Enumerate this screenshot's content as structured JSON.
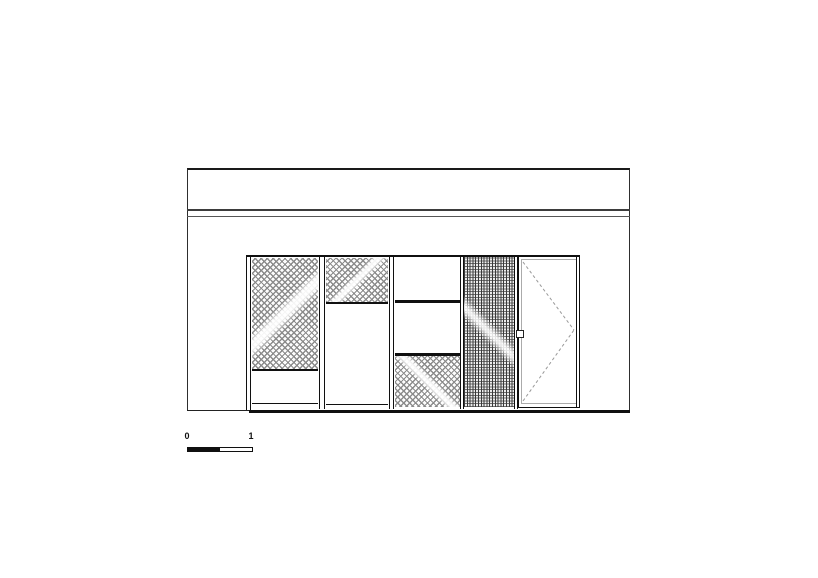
{
  "drawing": {
    "type": "architectural-front-elevation",
    "scale_bar": {
      "start_label": "0",
      "end_label": "1"
    },
    "facade": {
      "parapet_lines": 2,
      "panels": [
        {
          "id": "panel-1",
          "pattern": "mesh",
          "layout": "mesh-top-solid-bottom"
        },
        {
          "id": "panel-2",
          "pattern": "mesh",
          "layout": "mesh-top-tall-solid-bottom"
        },
        {
          "id": "panel-3",
          "pattern": "mesh",
          "layout": "solid-solid-mesh-bottom"
        },
        {
          "id": "panel-4",
          "pattern": "dense-mesh",
          "layout": "full-height-mesh"
        },
        {
          "id": "door",
          "pattern": "plain",
          "swing_indicator": "dashed-diagonals-to-right-jamb",
          "handle_side": "left"
        }
      ]
    },
    "colors": {
      "line": "#1a1a1a",
      "mesh_hatch": "#8b8b8b",
      "dense_hatch": "#3a3a3a",
      "swing_dash": "#999999",
      "background": "#ffffff"
    }
  }
}
